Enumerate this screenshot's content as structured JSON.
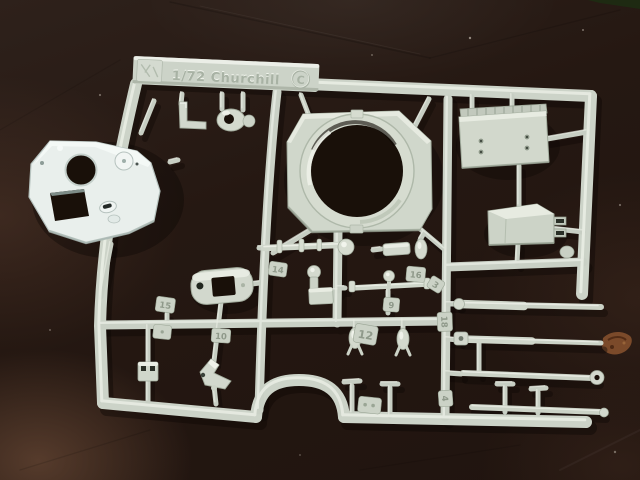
{
  "meta": {
    "scene_type": "photograph",
    "subject": "Light grey injection-molded sprue (parts tree) of a 1/72 scale Churchill tank model kit lying on a dark brown leather surface"
  },
  "sprue": {
    "embossed": {
      "full_line": "1/72 Churchill",
      "scale_text": "1/72",
      "subject_text": "Churchill",
      "circled_letter": "C"
    },
    "colors": {
      "plastic": "#ccd3c8",
      "plastic_light": "#e9ede4",
      "plastic_shadow": "#9aa495",
      "white_part": "#eaf0ee",
      "hole_dark": "#191009"
    },
    "part_tags": [
      {
        "number": "14"
      },
      {
        "number": "16"
      },
      {
        "number": "3"
      },
      {
        "number": "9"
      },
      {
        "number": "12"
      },
      {
        "number": "18"
      },
      {
        "number": "4"
      },
      {
        "number": "15"
      },
      {
        "number": "10"
      }
    ],
    "parts": [
      "turret roof plate",
      "hull top with turret ring",
      "engine deck plate",
      "air intake box",
      "cupola hatch base",
      "gun barrel section",
      "periscope",
      "axle cross",
      "fire extinguishers",
      "long gun barrel rods",
      "tow rod",
      "smoke discharger handles",
      "mount bracket",
      "clamp block"
    ]
  },
  "background": {
    "surface": "dark leather desk mat",
    "colors": {
      "base": "#241813",
      "warm_highlight": "#7a5642",
      "corner_object_green": "#1e2a12",
      "scratch_mark": "#84502c"
    }
  }
}
